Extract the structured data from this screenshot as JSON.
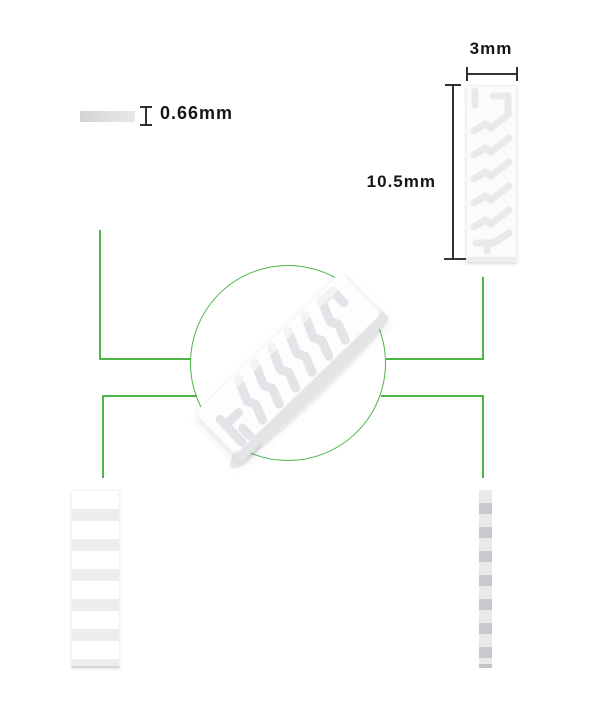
{
  "diagram": {
    "dimensions": {
      "thickness_label": "0.66mm",
      "width_label": "3mm",
      "height_label": "10.5mm"
    },
    "colors": {
      "accent_green": "#4db648",
      "dimension_line_black": "#1a1a1a",
      "ceramic_white": "#fafbfb",
      "heater_trace_gray": "#e7e9eb",
      "band_gray": "#ebedef",
      "side_strip_gray": "#c9cacd"
    },
    "views": {
      "thickness_view": "thickness-sample-bar",
      "front_view": "front-view-with-serpentine-trace",
      "center_view": "3d-isometric-unit-in-circle",
      "back_view": "back-view-horizontal-bands",
      "side_view": "thin-side-profile-strip"
    }
  }
}
